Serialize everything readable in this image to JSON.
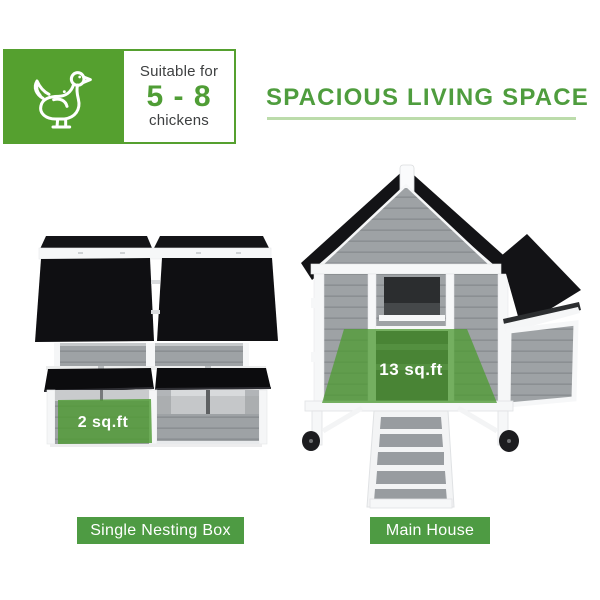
{
  "badge": {
    "icon": "chicken",
    "line1": "Suitable for",
    "range": "5 - 8",
    "line2": "chickens"
  },
  "heading": {
    "title": "SPACIOUS LIVING SPACE"
  },
  "overlays": {
    "nesting_box_area": "2 sq.ft",
    "main_house_area": "13 sq.ft"
  },
  "captions": {
    "nesting_box": "Single Nesting Box",
    "main_house": "Main House"
  },
  "colors": {
    "brand_green": "#55a02f",
    "title_green": "#4f9d3e",
    "caption_green": "#4e9b43",
    "overlay_green": "#4f9b35",
    "roof_black": "#131316",
    "wood_gray": "#9ea2a5",
    "trim_white": "#f6f7f8"
  }
}
